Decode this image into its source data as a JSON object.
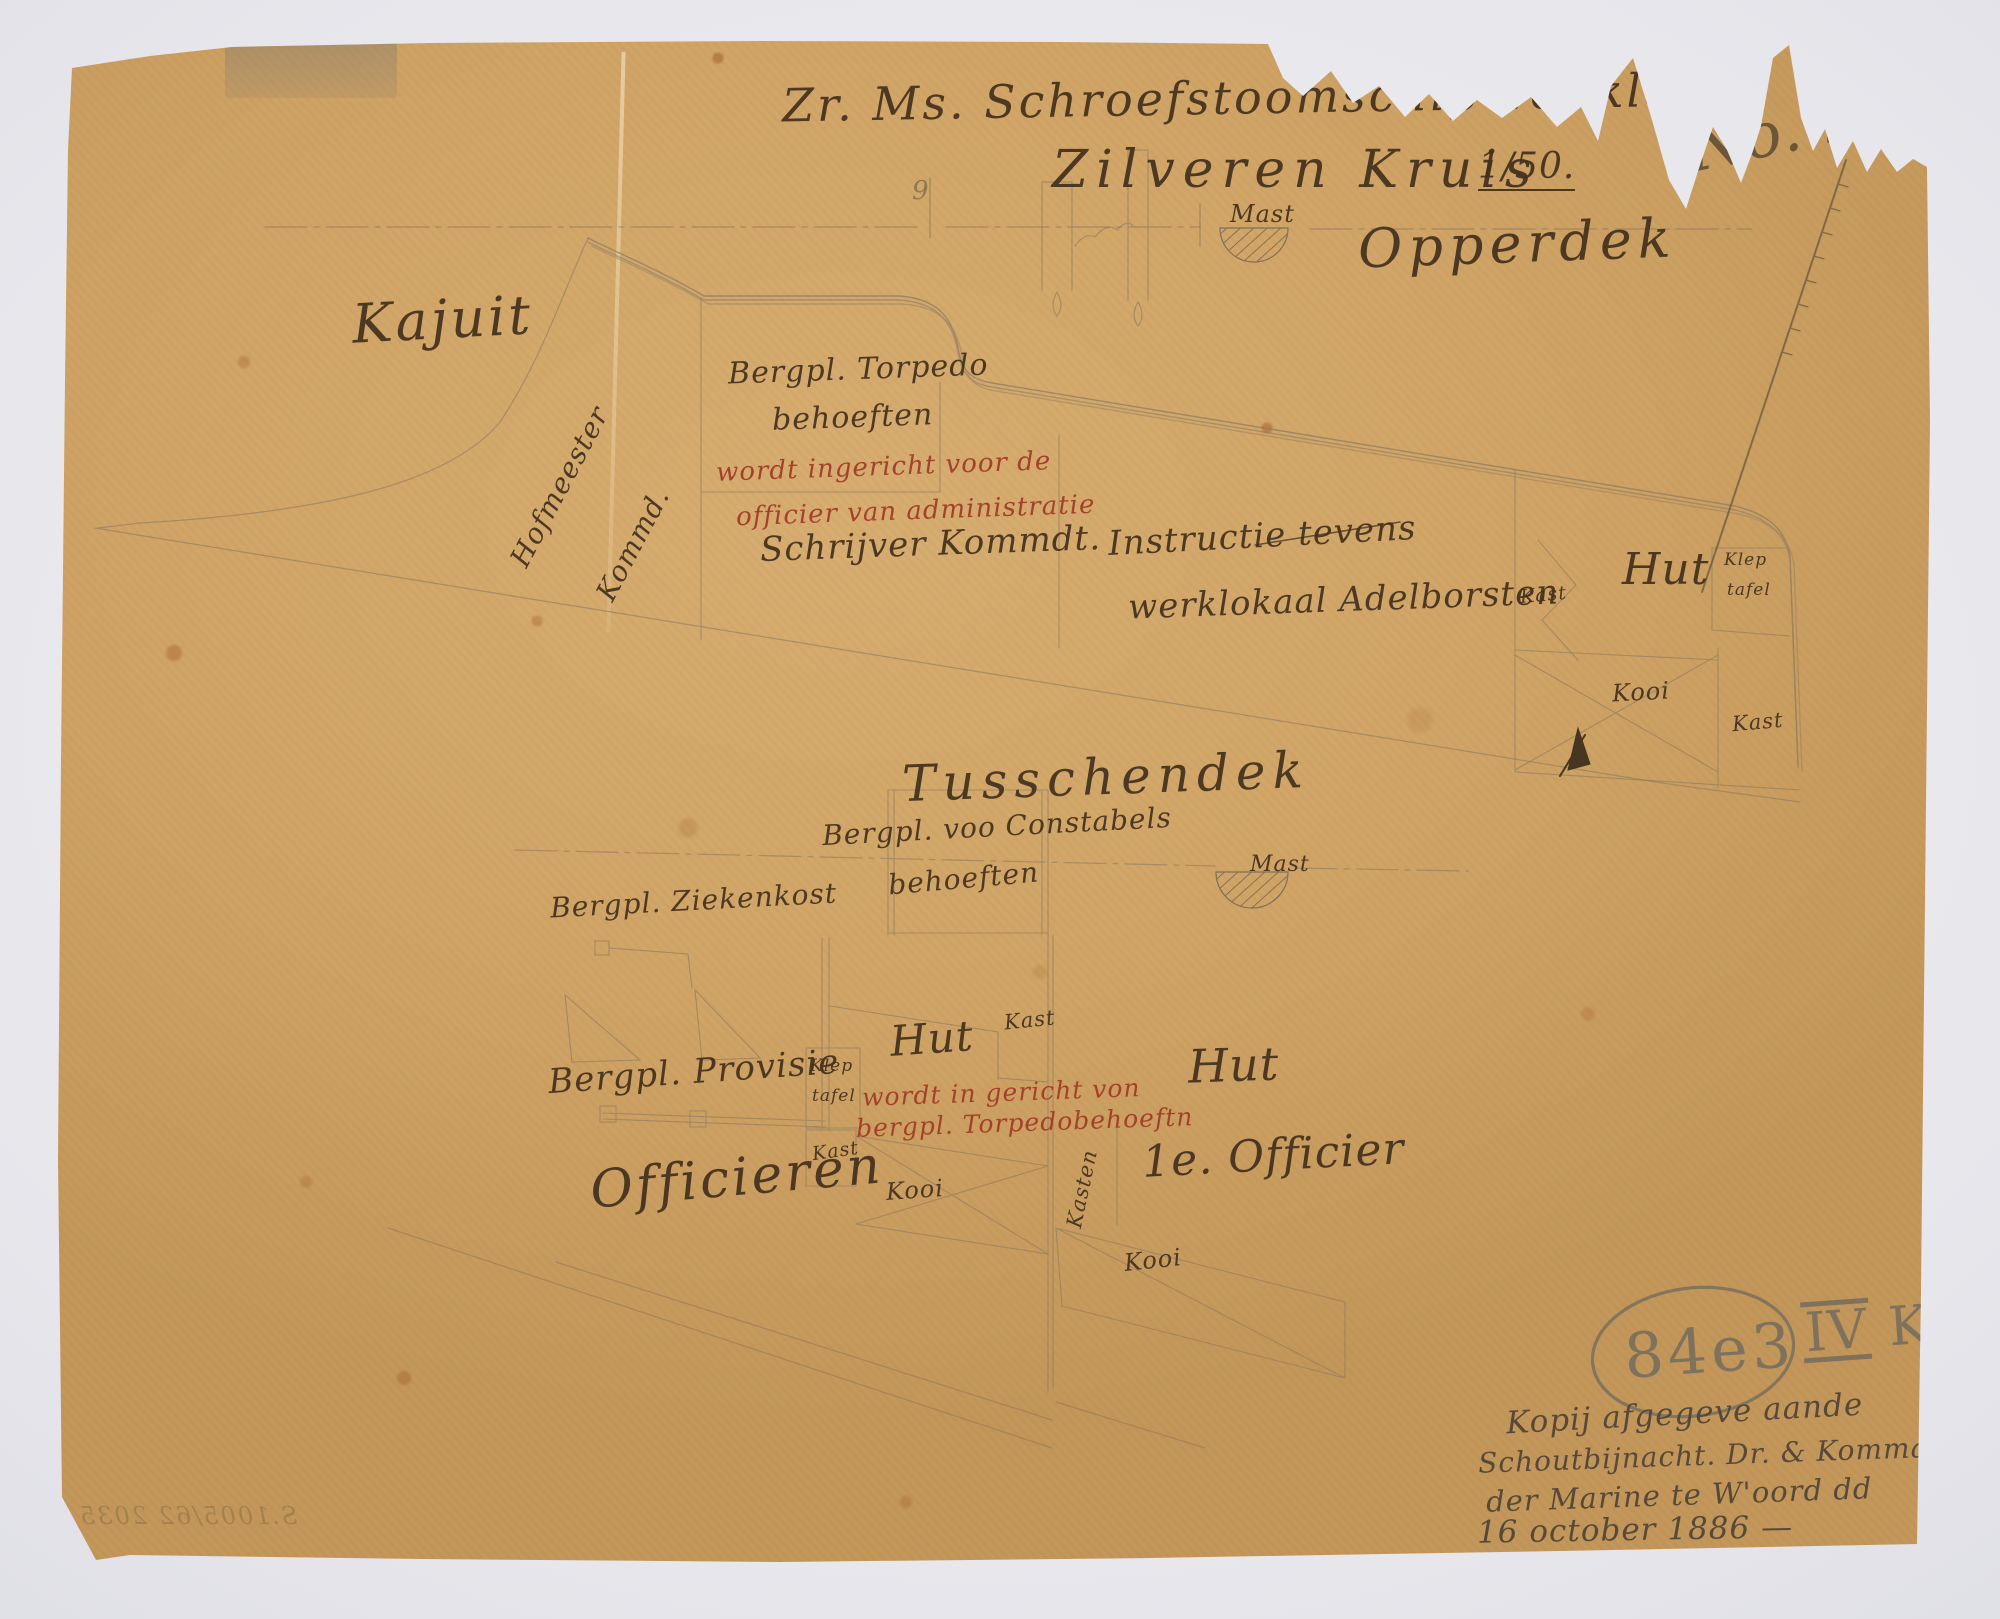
{
  "header": {
    "title_line1": "Zr. Ms. Schroefstoomschip 1e. klasse",
    "title_line2": "Zilveren Kruis",
    "scale": "1/50.",
    "sheet_number": "No. 9"
  },
  "upper_deck": {
    "label_kajuit": "Kajuit",
    "label_opperdek": "Opperdek",
    "label_mast": "Mast",
    "frame_number": "9",
    "hofmeester_line1": "Hofmeester",
    "hofmeester_line2": "Kommd.",
    "torpedo_room_line1": "Bergpl. Torpedo",
    "torpedo_room_line2": "behoeften",
    "torpedo_note_line1": "wordt ingericht voor de",
    "torpedo_note_line2": "officier van administratie",
    "room_schrijver": "Schrijver Kommdt.",
    "instructie_line1": "Instructie tevens",
    "instructie_line2": "werklokaal Adelborsten",
    "label_kast_door": "Kast",
    "label_hut": "Hut",
    "label_klep": "Klep",
    "label_tafel": "tafel",
    "label_kooi": "Kooi",
    "label_kast_corner": "Kast"
  },
  "lower_deck": {
    "label_tusschendek": "Tusschendek",
    "constabel_line1": "Bergpl. voo Constabels",
    "constabel_line2": "behoeften",
    "label_mast": "Mast",
    "room_ziekenkost": "Bergpl. Ziekenkost",
    "room_provisie": "Bergpl. Provisie",
    "label_officieren": "Officieren",
    "label_klep": "Klep",
    "label_tafel": "tafel",
    "label_hut_mid": "Hut",
    "note_mid_line1": "wordt in gericht von",
    "note_mid_line2": "bergpl. Torpedobehoeftn",
    "label_kast_top": "Kast",
    "label_kast_small": "Kast",
    "label_kasten": "Kasten",
    "label_hut_officier": "Hut",
    "label_officier": "1e. Officier",
    "label_kooi_left": "Kooi",
    "label_kooi_right": "Kooi"
  },
  "annotations": {
    "stamp_number": "84e3",
    "stamp_class_iv": "IV",
    "stamp_class_k": "K",
    "stamp_class_2": "2",
    "note_line1": "Kopij afgegeve aande",
    "note_line2": "Schoutbijnacht. Dr. & Kommandt",
    "note_line3": "der Marine te W'oord dd",
    "note_line4": "16 october 1886 —",
    "bleedthrough_text": "S.1005/62 2035"
  },
  "colors": {
    "paper": "#d0a466",
    "ink": "#43311e",
    "red_ink": "#a23a27",
    "pencil": "#82714f"
  }
}
